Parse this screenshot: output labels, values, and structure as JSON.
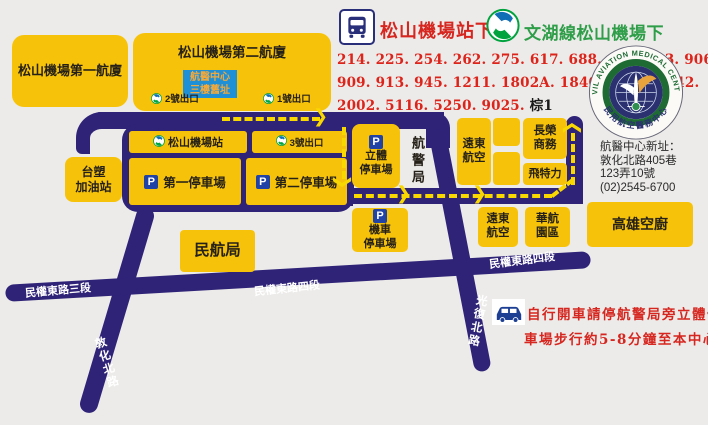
{
  "colors": {
    "background": "#ecebe9",
    "building_yellow": "#f7c30a",
    "road_navy": "#2f2378",
    "route_dash_yellow": "#f8d800",
    "red_text": "#d6261f",
    "green_text": "#2f9e49",
    "metro_green": "#00a33e",
    "metro_blue": "#0f6eb5",
    "old_site_box_blue": "#1f8fd6",
    "old_site_text_orange": "#f2a93b",
    "parking_badge_blue": "#2143a6"
  },
  "header": {
    "bus_stop_title": "松山機場站下",
    "metro_line_title": "文湖線松山機場下",
    "bus_routes_line1": "214. 225. 254. 262. 275. 617. 688. 801. 803. 906",
    "bus_routes_line2": "909. 913. 945. 1211. 1802A. 1840. 1841. 1842.",
    "bus_routes_line3": "2002. 5116. 5250. 9025.",
    "bus_routes_line3_suffix": "棕1"
  },
  "logo": {
    "ring_text_en": "CIVIL AVIATION MEDICAL CENTER",
    "ring_text_zh": "民用航空醫務中心"
  },
  "address": {
    "line1": "航醫中心新址：",
    "line2": "敦化北路405巷",
    "line3": "123弄10號",
    "line4": "(02)2545-6700"
  },
  "drive_note": {
    "line1": "自行開車請停航警局旁立體停",
    "line2": "車場步行約5-8分鐘至本中心"
  },
  "terminals": {
    "t1": "松山機場第一航廈",
    "t2": "松山機場第二航廈"
  },
  "old_site": {
    "line1": "航醫中心",
    "line2": "三樓舊址"
  },
  "metro": {
    "station": "松山機場站",
    "exit1": "1號出口",
    "exit2": "2號出口",
    "exit3": "3號出口"
  },
  "parking": {
    "p": "P",
    "lot1": "第一停車場",
    "lot2": "第二停車場",
    "multi_line1": "立體",
    "multi_line2": "停車場",
    "moto_line1": "機車",
    "moto_line2": "停車場"
  },
  "buildings": {
    "gas_line1": "台塑",
    "gas_line2": "加油站",
    "police": "航警局",
    "fareast_top_line1": "遠東",
    "fareast_top_line2": "航空",
    "evergreen_line1": "長榮",
    "evergreen_line2": "商務",
    "fitly": "飛特力",
    "fareast_bottom_line1": "遠東",
    "fareast_bottom_line2": "航空",
    "cal_park_line1": "華航",
    "cal_park_line2": "園區",
    "kitchen": "高雄空廚",
    "caa": "民航局"
  },
  "roads": {
    "minquan3": "民權東路三段",
    "minquan4_mid": "民權東路四段",
    "minquan4_right": "民權東路四段",
    "dunhua": "敦化北路",
    "guangfu": "光復北路"
  }
}
